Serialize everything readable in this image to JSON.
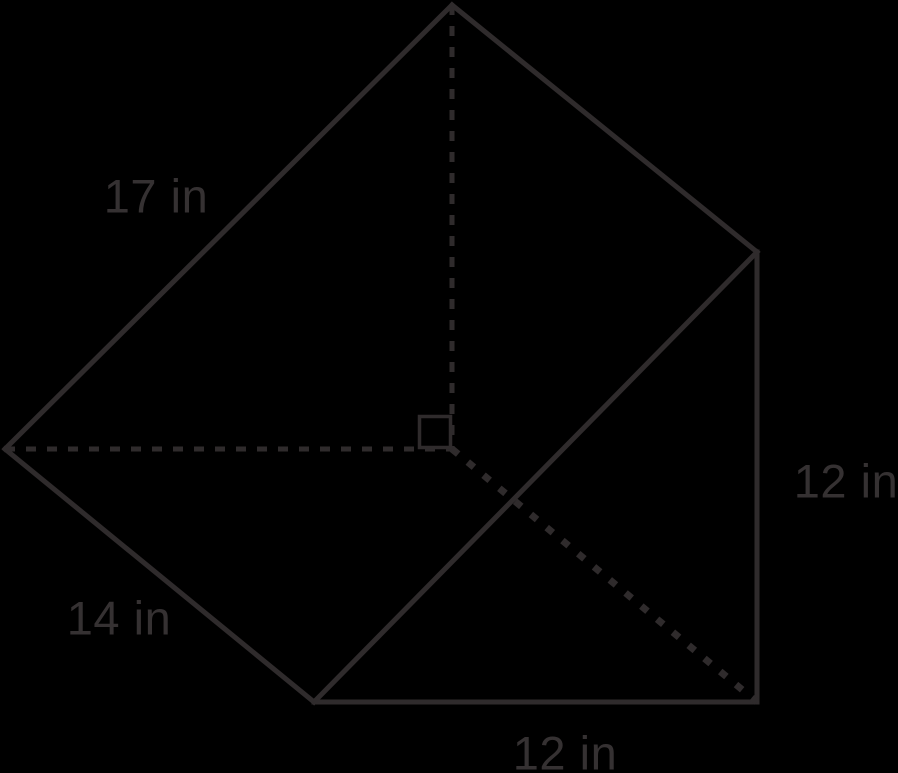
{
  "page": {
    "background_color": "#000000",
    "width": 898,
    "height": 773
  },
  "figure": {
    "shape": "triangular-prism",
    "stroke_color": "#2f2b2c",
    "text_color": "#353132",
    "stroke_widths": {
      "solid": 5,
      "dashed": 5,
      "dotted": 7
    },
    "dash_patterns": {
      "solid": "",
      "dashed": "10 11",
      "dotted": "8 12.5"
    },
    "vertices": {
      "apex": [
        452,
        5
      ],
      "top_right": [
        757,
        252
      ],
      "bottom_right": [
        757,
        702
      ],
      "bottom_left": [
        314,
        702
      ],
      "left": [
        5,
        449
      ],
      "altitude_foot": [
        452,
        449
      ]
    },
    "edges": [
      {
        "name": "hypotenuse-front",
        "from": "apex",
        "to": "left",
        "style": "solid"
      },
      {
        "name": "ridge-top",
        "from": "apex",
        "to": "top_right",
        "style": "solid"
      },
      {
        "name": "lateral-left",
        "from": "left",
        "to": "bottom_left",
        "style": "solid"
      },
      {
        "name": "bottom-edge",
        "from": "bottom_left",
        "to": "bottom_right",
        "style": "solid"
      },
      {
        "name": "right-vertical-edge",
        "from": "top_right",
        "to": "bottom_right",
        "style": "solid"
      },
      {
        "name": "front-diagonal",
        "from": "bottom_left",
        "to": "top_right",
        "style": "solid"
      },
      {
        "name": "altitude-dashed",
        "from": "apex",
        "to": "altitude_foot",
        "style": "dashed"
      },
      {
        "name": "base-dashed",
        "from": "left",
        "to": "altitude_foot",
        "style": "dashed"
      },
      {
        "name": "hidden-edge-dotted",
        "from": "altitude_foot",
        "to": "bottom_right",
        "style": "dotted"
      }
    ],
    "right_angle_marker": {
      "x": 419.5,
      "y": 416.5,
      "size": 31,
      "stroke_width": 3.5
    },
    "labels": [
      {
        "name": "label-17-in",
        "text": "17 in",
        "x": 156,
        "y": 196
      },
      {
        "name": "label-12-in-right",
        "text": "12 in",
        "x": 846,
        "y": 481
      },
      {
        "name": "label-14-in",
        "text": "14 in",
        "x": 119,
        "y": 618
      },
      {
        "name": "label-12-in-bottom",
        "text": "12 in",
        "x": 565,
        "y": 753
      }
    ]
  }
}
